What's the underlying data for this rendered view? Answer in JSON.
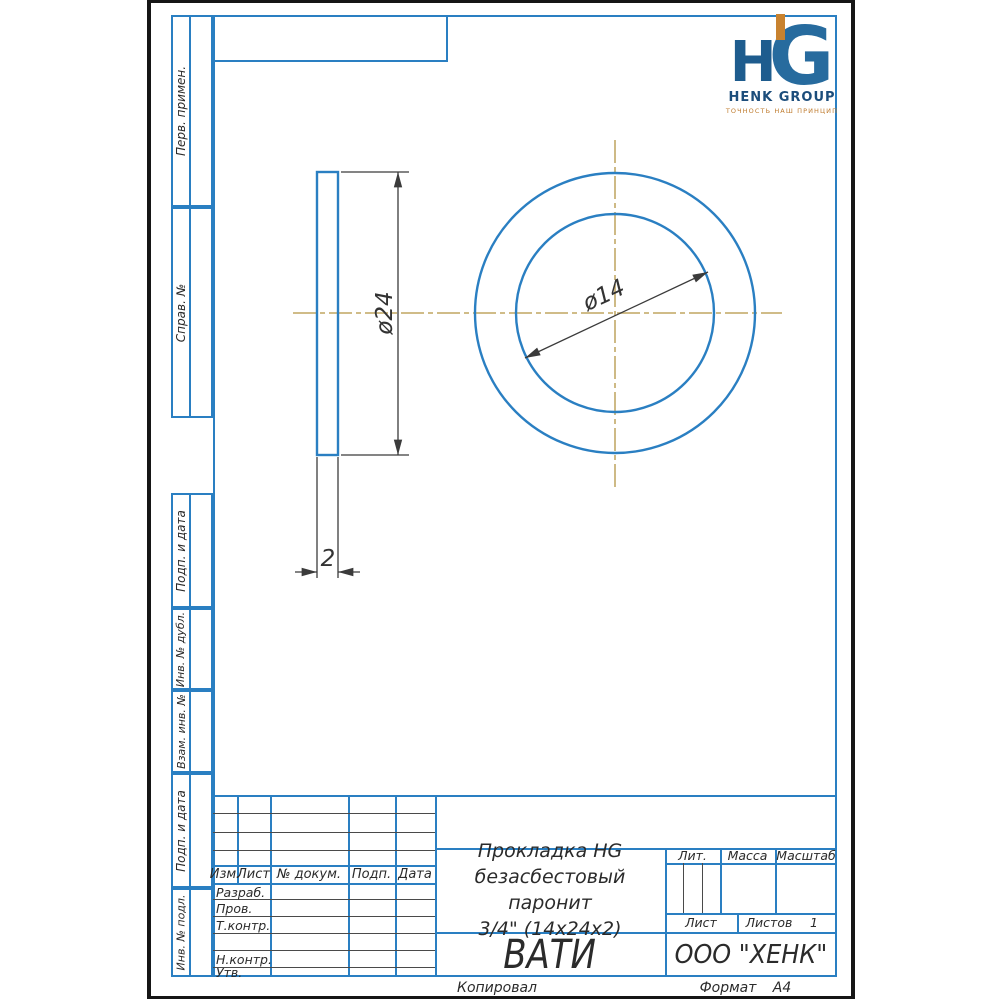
{
  "page": {
    "footer": {
      "copied": "Копировал",
      "format_label": "Формат",
      "format_value": "А4"
    }
  },
  "logo": {
    "mark": {
      "h": "H",
      "g": "G"
    },
    "company": "HENK GROUP",
    "tagline": "ТОЧНОСТЬ НАШ ПРИНЦИП",
    "colors": {
      "navy": "#1e5c8e",
      "orange": "#c8822f"
    }
  },
  "margin_columns": {
    "items": [
      {
        "label": "Перв. примен."
      },
      {
        "label": "Справ. №"
      },
      {
        "label": "Подп. и дата"
      },
      {
        "label": "Инв. № дубл."
      },
      {
        "label": "Взам. инв. №"
      },
      {
        "label": "Подп. и дата"
      },
      {
        "label": "Инв. № подл."
      }
    ]
  },
  "title_block": {
    "revision_header": {
      "izm": "Изм.",
      "list": "Лист",
      "doc": "№ докум.",
      "sign": "Подп.",
      "date": "Дата"
    },
    "staff": [
      {
        "label": "Разраб."
      },
      {
        "label": "Пров."
      },
      {
        "label": "Т.контр."
      },
      {
        "label": ""
      },
      {
        "label": "Н.контр."
      },
      {
        "label": "Утв."
      }
    ],
    "name_line1": "Прокладка HG",
    "name_line2": "безасбестовый паронит",
    "name_line3": "3/4\" (14х24х2)",
    "material": "ВАТИ",
    "company": "ООО \"ХЕНК\"",
    "lit_label": "Лит.",
    "mass_label": "Масса",
    "scale_label": "Масштаб",
    "sheet_label": "Лист",
    "sheets_label": "Листов",
    "sheets_value": "1"
  },
  "drawing": {
    "dim_outer_label": "ø24",
    "dim_inner_label": "ø14",
    "dim_thickness_label": "2",
    "colors": {
      "outline": "#2a7fc2",
      "centerline": "#c9b278",
      "dimension": "#3b3b3b"
    }
  }
}
